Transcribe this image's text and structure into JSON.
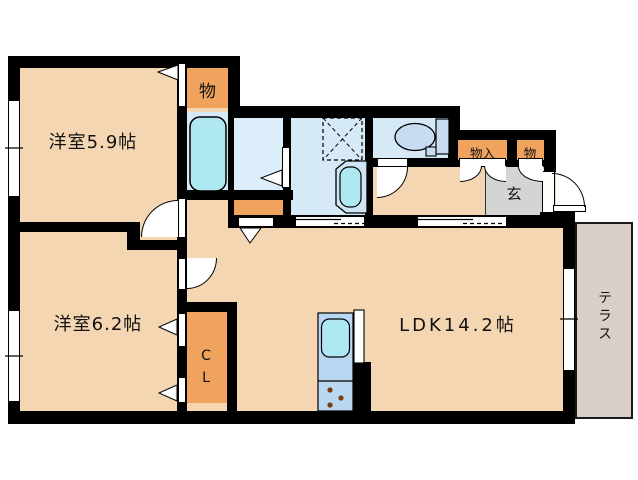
{
  "type": "floor-plan",
  "labels": {
    "room1": "洋室5.9帖",
    "room2": "洋室6.2帖",
    "ldk": "LDK14.2帖",
    "storage_top": "物",
    "storage_in": "物入",
    "storage_right": "物",
    "genkan": "玄",
    "closet": "CL",
    "terrace": "テラス"
  },
  "palette": {
    "floor_beige": "#f4d7b2",
    "wet_blue": "#d6e9f7",
    "fixture_cyan": "#aee9f2",
    "kitchen_blue": "#b9d7f0",
    "toilet_blue": "#c7dcf2",
    "storage_orange": "#f0a35c",
    "genkan_gray": "#d4d4d4",
    "terrace_gray": "#d8d0c8",
    "wall_black": "#000000"
  },
  "fixtures": [
    "bathtub",
    "toilet",
    "washbasin",
    "washing-machine-pan",
    "kitchen-sink",
    "gas-stove"
  ]
}
